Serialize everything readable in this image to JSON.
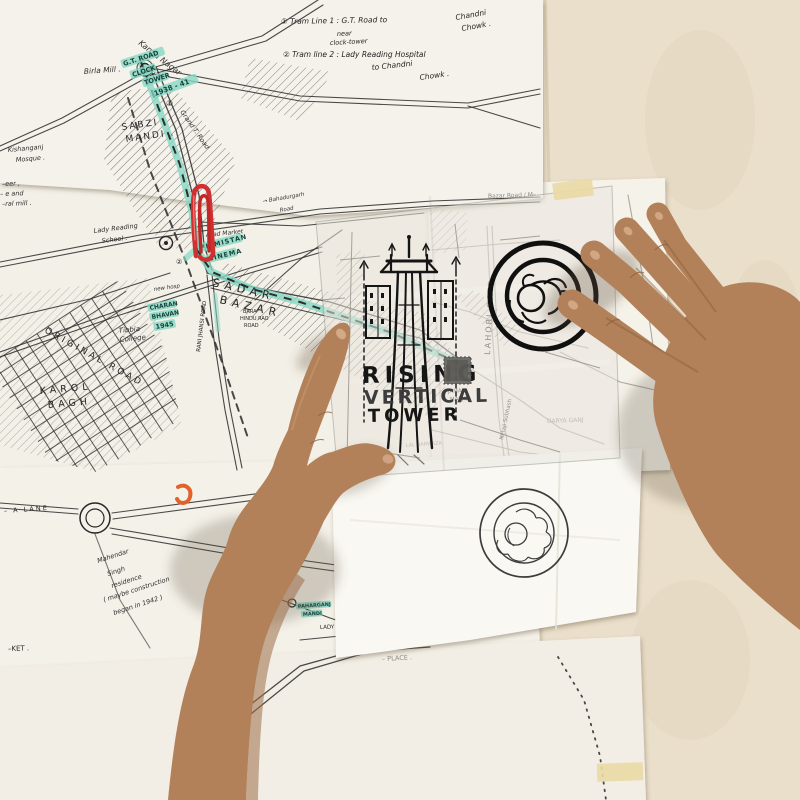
{
  "scene": {
    "description": "photograph of two hands over hand-drawn maps of Old Delhi pinned to a wall",
    "objects": [
      "hand-drawn street maps",
      "tracing paper overlay",
      "red paperclip",
      "orange paperclip",
      "masking tape",
      "left hand pointing at tower sketch",
      "right hand resting near circular rosette sketch",
      "bold tower elevation sketch",
      "double-circle rosette sketch on tracing",
      "lighter double-circle rosette sketch on paper below"
    ]
  },
  "colors": {
    "wall": "#e8ddc6",
    "paper": "#f4f1e9",
    "paper_bright": "#f9f8f3",
    "tracing": "#e9e6de",
    "teal_highlight": "#86d7c3",
    "ink_pen": "#262626",
    "ink_pencil": "#8f8b80",
    "marker_black": "#141414",
    "paperclip_red": "#d03030",
    "clip_orange": "#e3622c",
    "tape": "#ead9a4",
    "skin": "#b28159"
  },
  "overlay": {
    "sketch": "vertical transmission-tower elevation drawn in bold marker",
    "title_line1": "RISING",
    "title_line2": "VERTICAL",
    "title_line3": "TOWER"
  },
  "notes": [
    {
      "id": "tram1a",
      "text": "① Tram Line 1 : G.T. Road to"
    },
    {
      "id": "tram1b",
      "text": "Chandni"
    },
    {
      "id": "tram1c",
      "text": "Chowk ."
    },
    {
      "id": "tram1d",
      "text": "near"
    },
    {
      "id": "tram1e",
      "text": "clock-tower"
    },
    {
      "id": "tram2a",
      "text": "② Tram line 2 : Lady Reading Hospital"
    },
    {
      "id": "tram2b",
      "text": "to Chandni"
    },
    {
      "id": "tram2c",
      "text": "Chowk ."
    }
  ],
  "map_labels": [
    {
      "id": "kamla",
      "text": "Kamla Nagar",
      "kind": "script"
    },
    {
      "id": "birla",
      "text": "Birla Mill .",
      "kind": "script"
    },
    {
      "id": "sabzi",
      "text": "SABZI",
      "kind": "pen"
    },
    {
      "id": "mandi",
      "text": "MANDI .",
      "kind": "pen"
    },
    {
      "id": "gtroadhl",
      "text": "G.T. ROAD",
      "kind": "teal"
    },
    {
      "id": "clockhl",
      "text": "CLOCK",
      "kind": "teal"
    },
    {
      "id": "towerhl",
      "text": "TOWER",
      "kind": "teal"
    },
    {
      "id": "yearhl",
      "text": "1938 - 41",
      "kind": "teal"
    },
    {
      "id": "mk1",
      "text": "①",
      "kind": "pen"
    },
    {
      "id": "gtdiag",
      "text": "Grand T. Road",
      "kind": "script"
    },
    {
      "id": "kish1",
      "text": "Kishanganj",
      "kind": "script"
    },
    {
      "id": "kish2",
      "text": "Mosque .",
      "kind": "script"
    },
    {
      "id": "frag1",
      "text": "–eer ,",
      "kind": "script"
    },
    {
      "id": "frag2",
      "text": "– e and",
      "kind": "script"
    },
    {
      "id": "frag3",
      "text": "–ral mill .",
      "kind": "script"
    },
    {
      "id": "lady1",
      "text": "Lady Reading",
      "kind": "script"
    },
    {
      "id": "lady1b",
      "text": "School .",
      "kind": "script"
    },
    {
      "id": "bah1",
      "text": "→ Bahadurgarh",
      "kind": "script"
    },
    {
      "id": "bah2",
      "text": "Road",
      "kind": "script"
    },
    {
      "id": "azad",
      "text": "Azad Market",
      "kind": "script"
    },
    {
      "id": "film1",
      "text": "FILMISTAN",
      "kind": "teal"
    },
    {
      "id": "film2",
      "text": "CINEMA",
      "kind": "teal"
    },
    {
      "id": "sadar",
      "text": "SADAR",
      "kind": "pen"
    },
    {
      "id": "bazar",
      "text": "BAZAR",
      "kind": "pen"
    },
    {
      "id": "ranij",
      "text": "RANI JHANSI ROAD",
      "kind": "pen"
    },
    {
      "id": "charan",
      "text": "CHARAN",
      "kind": "teal"
    },
    {
      "id": "bhavan",
      "text": "BHAVAN",
      "kind": "teal"
    },
    {
      "id": "y1945",
      "text": "1945",
      "kind": "teal"
    },
    {
      "id": "newh",
      "text": "new hosp",
      "kind": "script"
    },
    {
      "id": "tib1",
      "text": "Tibbia",
      "kind": "script"
    },
    {
      "id": "tib2",
      "text": "College",
      "kind": "script"
    },
    {
      "id": "orig",
      "text": "ORIGINAL ROAD",
      "kind": "pen"
    },
    {
      "id": "karol",
      "text": "KAROL",
      "kind": "pen"
    },
    {
      "id": "bagh",
      "text": "BAGH",
      "kind": "pen"
    },
    {
      "id": "bara1",
      "text": "BARA",
      "kind": "pen"
    },
    {
      "id": "bara2",
      "text": "HINDU RAO",
      "kind": "pen"
    },
    {
      "id": "bara3",
      "text": "ROAD",
      "kind": "pen"
    },
    {
      "id": "mk2",
      "text": "②",
      "kind": "pen"
    },
    {
      "id": "lahori",
      "text": "LAHORI GATE",
      "kind": "pen"
    },
    {
      "id": "bzhdr",
      "text": "Bazar Road / M–",
      "kind": "pencil"
    },
    {
      "id": "jama1",
      "text": "JAMA",
      "kind": "pen"
    },
    {
      "id": "jama2",
      "text": "MASJID.",
      "kind": "pen"
    },
    {
      "id": "netaji",
      "text": "Netaji Subhash",
      "kind": "pen"
    },
    {
      "id": "laldz",
      "text": "LAL DARWAZA",
      "kind": "pencil"
    },
    {
      "id": "sitaram",
      "text": "Sitaram Bazar",
      "kind": "pencil"
    },
    {
      "id": "darya",
      "text": "DARYA GANJ",
      "kind": "pencil"
    },
    {
      "id": "store",
      "text": "– STORE",
      "kind": "teal"
    },
    {
      "id": "pahar",
      "text": "PAHARGANJ",
      "kind": "teal"
    },
    {
      "id": "mandi2",
      "text": "MANDI",
      "kind": "teal"
    },
    {
      "id": "ladyh",
      "text": "LADY –",
      "kind": "pen"
    },
    {
      "id": "ket",
      "text": "–KET .",
      "kind": "pen"
    },
    {
      "id": "place",
      "text": "– PLACE .",
      "kind": "pencil"
    },
    {
      "id": "alane",
      "text": "– A LANE",
      "kind": "pen"
    },
    {
      "id": "mah1",
      "text": "Mahendar",
      "kind": "script"
    },
    {
      "id": "mah2",
      "text": "Singh",
      "kind": "script"
    },
    {
      "id": "mah3",
      "text": "residence",
      "kind": "script"
    },
    {
      "id": "mah4",
      "text": "( maybe construction",
      "kind": "script"
    },
    {
      "id": "mah5",
      "text": "began in 1942 )",
      "kind": "script"
    }
  ]
}
